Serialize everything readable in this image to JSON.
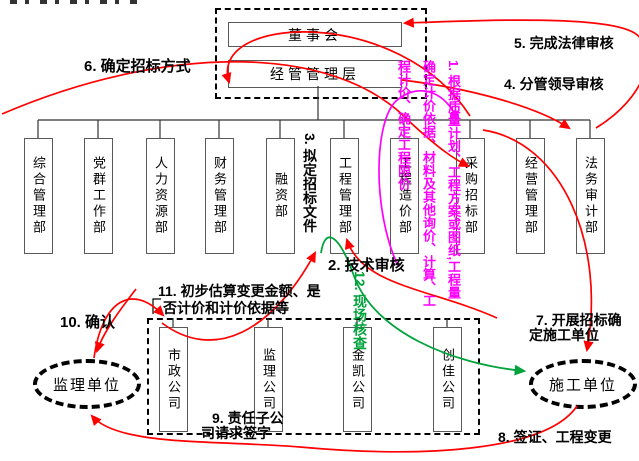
{
  "colors": {
    "flow_arrow": "#ff0000",
    "site_check_arrow": "#00a33c",
    "pricing_note": "#ff00ff",
    "box_border": "#595959"
  },
  "top": {
    "board": "董事会",
    "management": "经管管理层"
  },
  "departments": [
    "综合管理部",
    "党群工作部",
    "人力资源部",
    "财务管理部",
    "融资部",
    "工程管理部",
    "工程造价部",
    "采购招标部",
    "经营管理部",
    "法务审计部"
  ],
  "companies": [
    "市政公司",
    "监理公司",
    "金凯公司",
    "创佳公司"
  ],
  "units": {
    "supervision": "监理单位",
    "construction": "施工单位"
  },
  "steps": {
    "s1": "1. 根据质量计划、工程方案或图纸,工程量确定计价依据、材料及其他询价、计算、工程计价、确定工程限价",
    "s2": "2. 技术审核",
    "s3": "3. 拟定招标文件",
    "s4": "4. 分管领导审核",
    "s5": "5. 完成法律审核",
    "s6": "6. 确定招标方式",
    "s7_line1": "7. 开展招标确",
    "s7_line2": "定施工单位",
    "s8": "8. 签证、工程变更",
    "s9_line1": "9. 责任子公",
    "s9_line2": "司请求签字",
    "s10": "10. 确认",
    "s11_line1": "11. 初步估算变更金额、是",
    "s11_line2": "否计价和计价依据等",
    "s12": "12. 现场核查"
  }
}
